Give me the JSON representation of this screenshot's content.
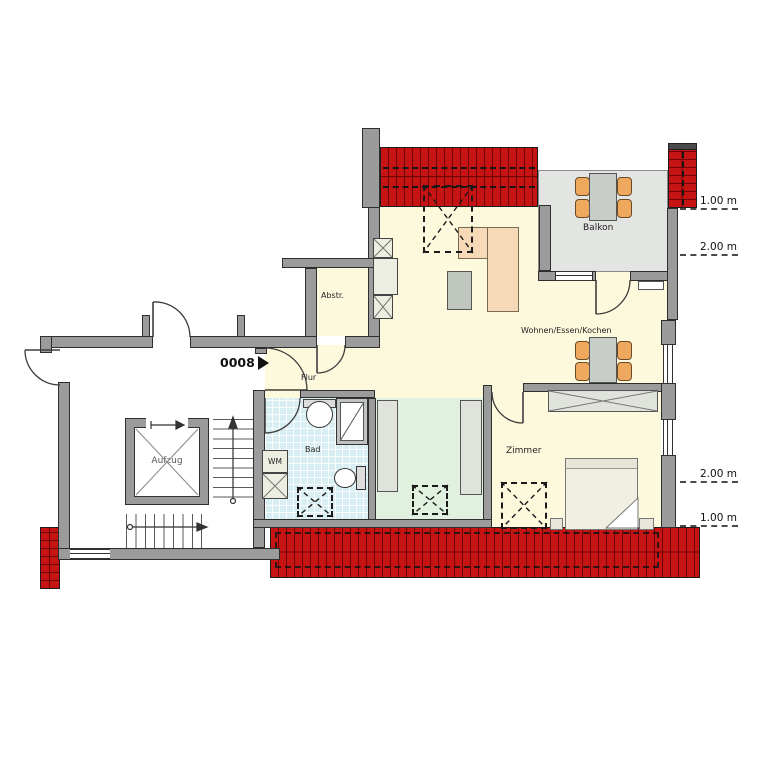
{
  "unit": {
    "number": "0008"
  },
  "rooms": {
    "balkon": "Balkon",
    "wohnen_essen_kochen": "Wohnen/Essen/Kochen",
    "abstellraum": "Abstr.",
    "flur": "Flur",
    "bad": "Bad",
    "wm": "WM",
    "zimmer": "Zimmer",
    "aufzug": "Aufzug"
  },
  "dimensions": {
    "right_top": [
      "1.00 m",
      "2.00 m"
    ],
    "right_bottom": [
      "2.00 m",
      "1.00 m"
    ]
  },
  "colors": {
    "roof": "#c61414",
    "wall": "#9b9b9b",
    "floor_main": "#fcf9dd",
    "floor_bath": "#d8eef2",
    "floor_dressing": "#e0f1e0",
    "floor_balcony": "#e3e5e2",
    "furniture_wood": "#efa95e",
    "furniture_sofa": "#f6d9b6"
  }
}
